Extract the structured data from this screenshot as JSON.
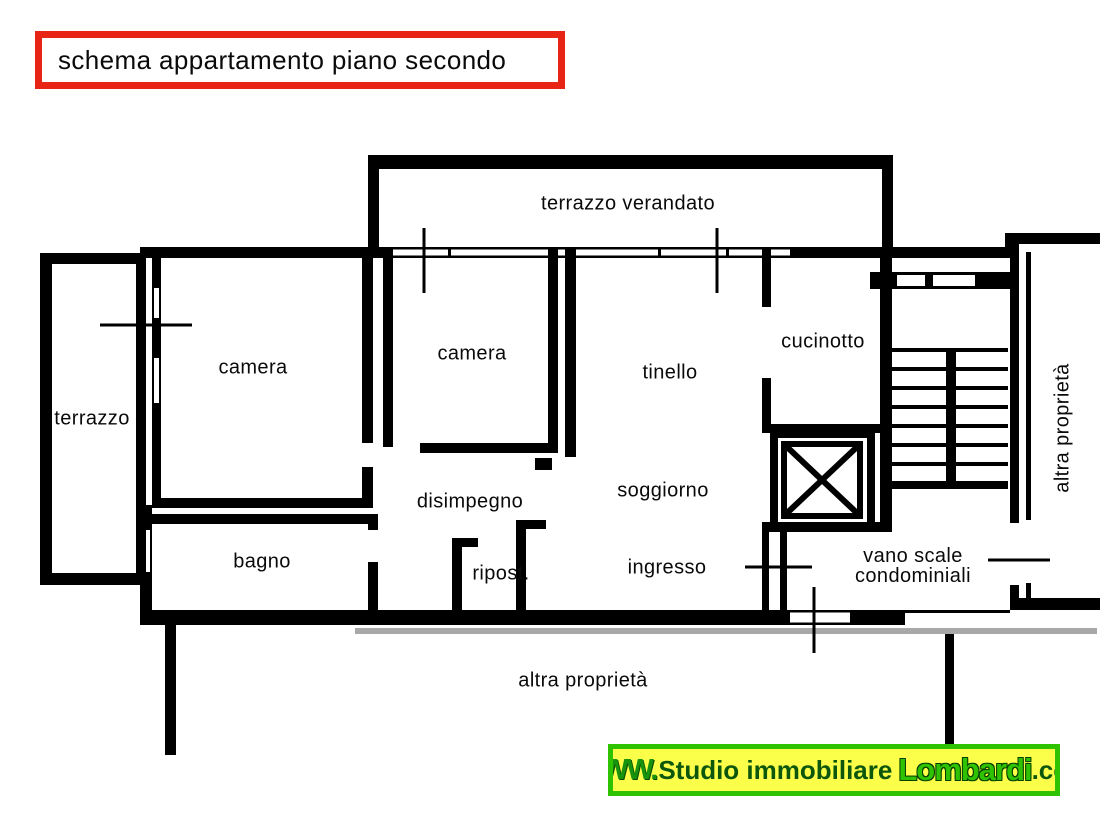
{
  "title": {
    "text": "schema appartamento piano secondo"
  },
  "rooms": {
    "terrazzo_verandato": "terrazzo verandato",
    "terrazzo": "terrazzo",
    "camera_1": "camera",
    "camera_2": "camera",
    "tinello": "tinello",
    "cucinotto": "cucinotto",
    "disimpegno": "disimpegno",
    "soggiorno": "soggiorno",
    "bagno": "bagno",
    "ripostiglio": "ripost.",
    "ingresso": "ingresso",
    "vano_scale_1": "vano scale",
    "vano_scale_2": "condominiali",
    "altra_proprieta_right": "altra proprietà",
    "altra_proprieta_bottom": "altra proprietà"
  },
  "watermark": {
    "www": "WWW.",
    "studio": "Studio immobiliare",
    "brand": "Lombardi",
    "tld": ".com",
    "background": "#fcff4a",
    "border": "#2ec200"
  },
  "colors": {
    "title_border": "#e82417",
    "plan_lines": "#000000",
    "shadow_gray": "#a8a8a8"
  }
}
